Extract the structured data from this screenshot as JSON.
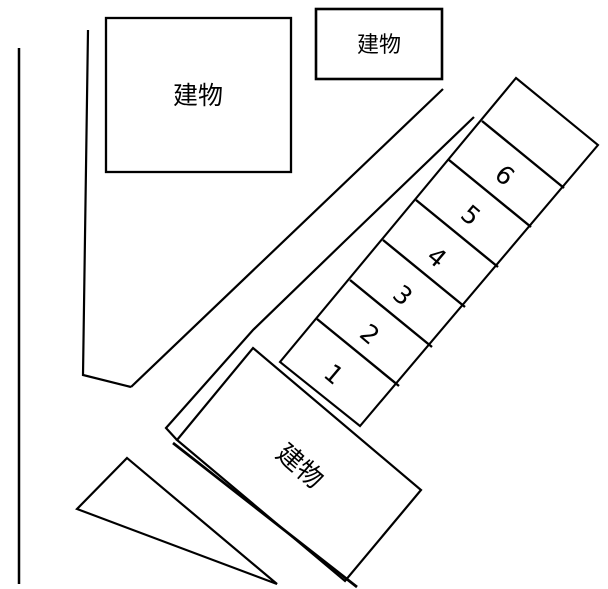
{
  "diagram": {
    "type": "parking-lot-site-plan",
    "background_color": "#ffffff",
    "line_color": "#000000",
    "buildings": [
      {
        "label": "建物",
        "position": "top-left"
      },
      {
        "label": "建物",
        "position": "top-center"
      },
      {
        "label": "建物",
        "position": "bottom-center",
        "rotation_deg": 41
      }
    ],
    "parking_spaces": [
      {
        "label": "1"
      },
      {
        "label": "2"
      },
      {
        "label": "3"
      },
      {
        "label": "4"
      },
      {
        "label": "5"
      },
      {
        "label": "6"
      }
    ]
  }
}
